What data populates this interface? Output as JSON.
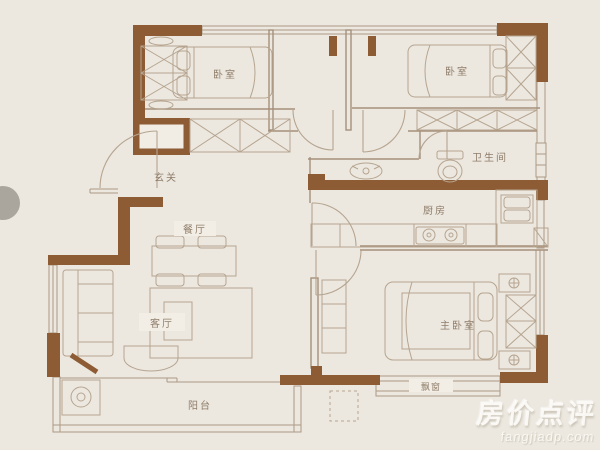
{
  "floorplan": {
    "rooms": {
      "bedroom_left": "卧室",
      "bedroom_right": "卧室",
      "bathroom": "卫生间",
      "kitchen": "厨房",
      "hallway": "玄关",
      "dining": "餐厅",
      "living": "客厅",
      "master_bedroom": "主卧室",
      "bay_window": "飘窗",
      "balcony": "阳台"
    },
    "colors": {
      "wall": "#8d5c35",
      "thin_line": "#a5907b",
      "furniture_line": "#b6a48f",
      "background": "#ece8e0",
      "label_text": "#8f7d69",
      "watermark": "#ffffff"
    }
  },
  "watermark": {
    "brand": "房价点评",
    "domain": "fangjiadp.com"
  }
}
